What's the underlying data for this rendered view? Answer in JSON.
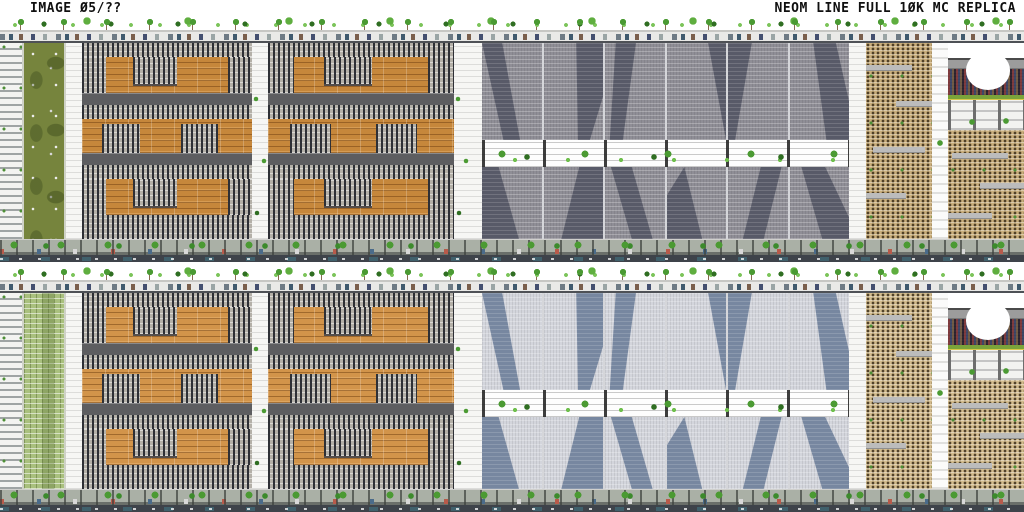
{
  "header": {
    "image_label": "IMAGE Ø5/??",
    "title": "NEOM LINE FULL 1ØK MC REPLICA"
  },
  "scene": {
    "subject": "Side elevation of the NEOM Line megastructure recreated in Minecraft, shown as two stacked panoramic strips",
    "panels": [
      {
        "id": "top-panel",
        "segment_label": "upper elevation strip",
        "glass_tint": "warm gray"
      },
      {
        "id": "bottom-panel",
        "segment_label": "lower elevation strip",
        "glass_tint": "cool blue"
      }
    ],
    "features": [
      "rooftop tree line",
      "rooftop service deck with vehicles",
      "striped end facade",
      "terraced roof garden strip",
      "orange residential mega-blocks with window patches",
      "gray sky-bridge bands",
      "glass towers with dark diagonal facets",
      "mid-level tree-lined walkway",
      "sand-colored towers with balcony slabs",
      "elevated stadium with oval field opening",
      "street-level arcade with trees and vehicles",
      "dark base strip"
    ],
    "palette": {
      "ink": "#101010",
      "orange": "#c6873b",
      "orange_bright": "#d2944a",
      "window_face": "#b4b0a8",
      "window_glass": "#2e3036",
      "band": "#5d5d60",
      "glass_warm": "#8f8e96",
      "glass_warm_dark": "#585a68",
      "glass_cool": "#d3d5dc",
      "glass_cool_dark": "#7787a0",
      "garden_olive": "#76843d",
      "garden_leaf": "#a9c07e",
      "tan_warm": "#c9ae7c",
      "tan_cool": "#d2bb8d",
      "slab": "#bcbcbc",
      "tree": "#4b9a33",
      "tree_deep": "#2f6e22",
      "pitch": "#7aa33a",
      "crowd": "#4d3f49",
      "base": "#3e434a"
    }
  }
}
